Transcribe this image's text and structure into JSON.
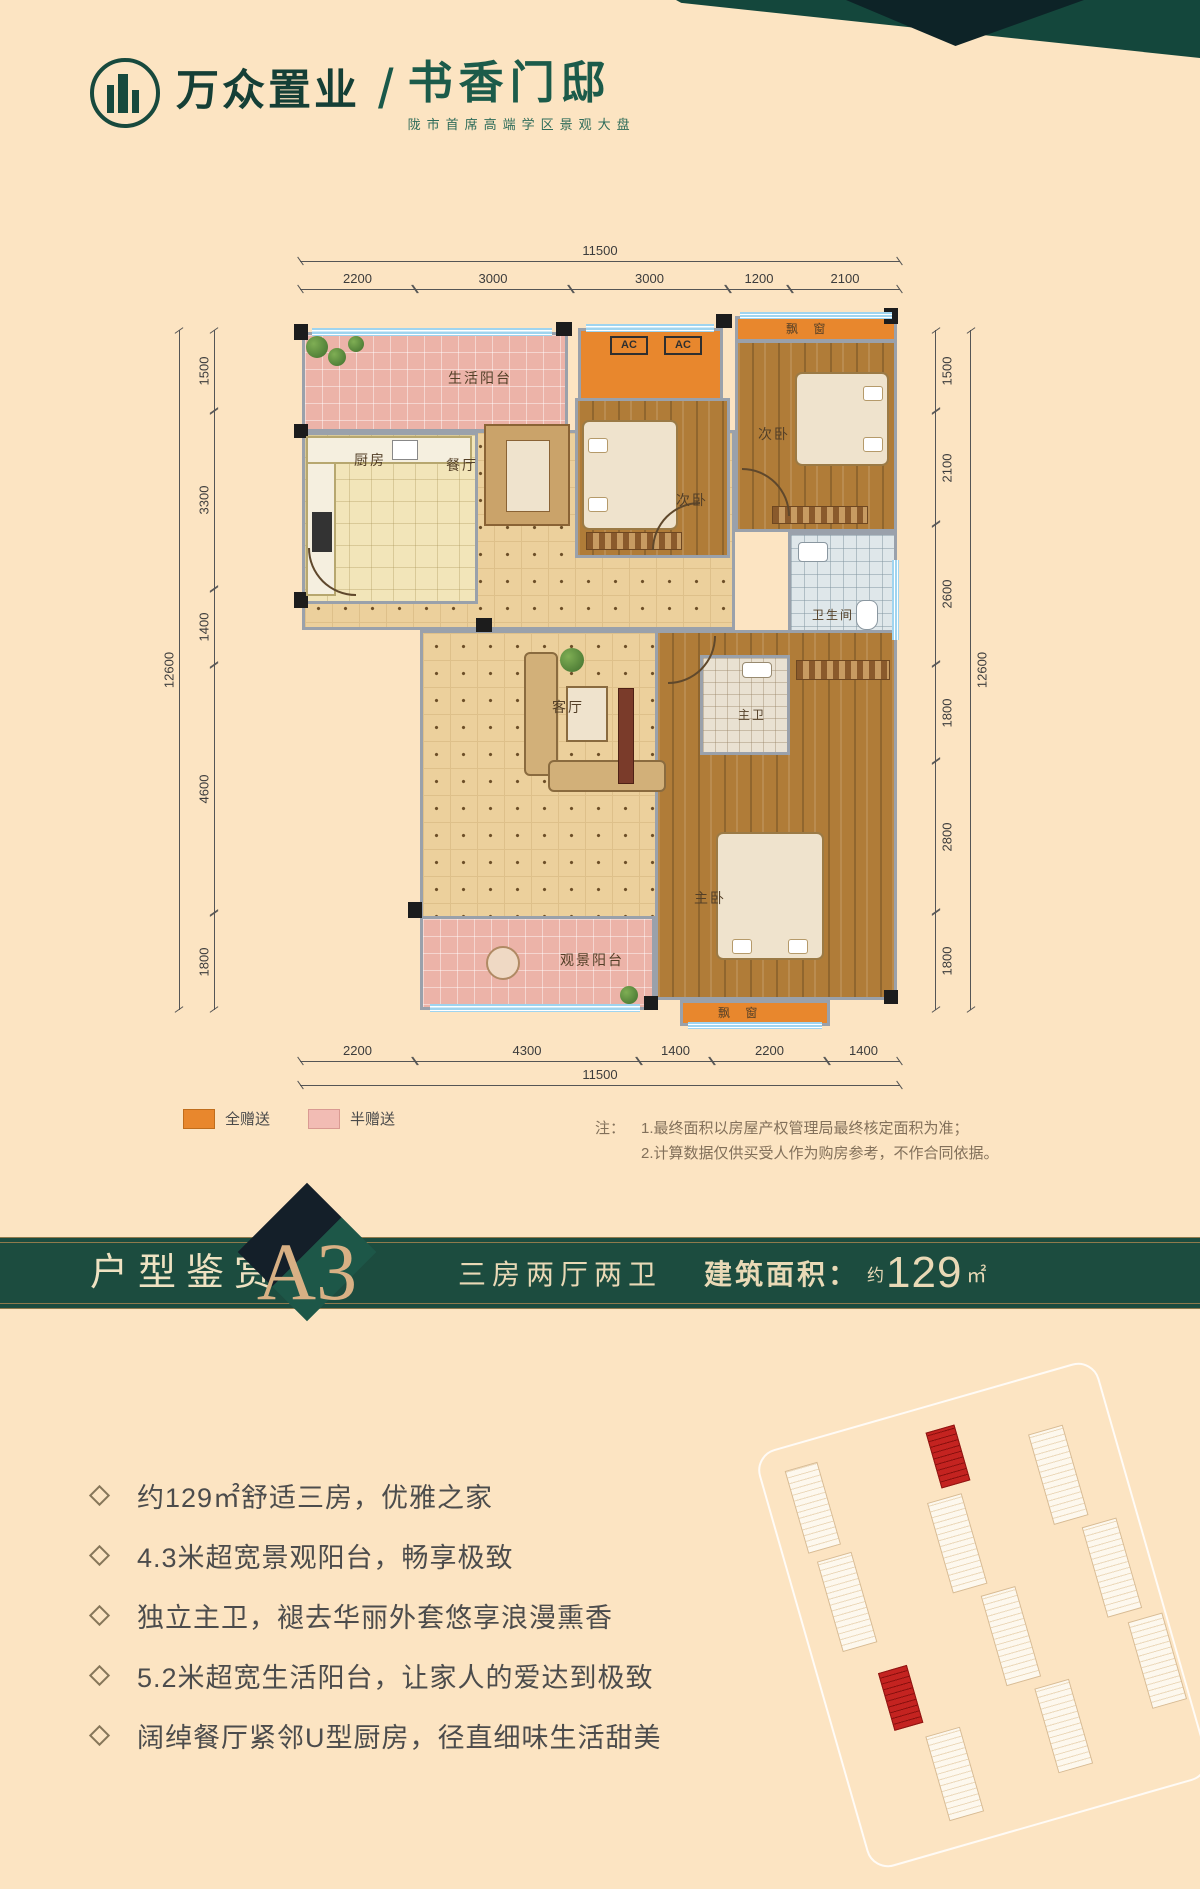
{
  "brand": {
    "company": "万众置业",
    "divider": "/",
    "project": "书香门邸",
    "tagline": "陇市首席高端学区景观大盘"
  },
  "plan": {
    "rooms": {
      "living_balcony": "生活阳台",
      "kitchen": "厨房",
      "dining": "餐厅",
      "secondary_bedroom": "次卧",
      "living_room": "客厅",
      "bathroom": "卫生间",
      "master_bathroom": "主卫",
      "master_bedroom": "主卧",
      "view_balcony": "观景阳台",
      "bay_window": "飘 窗",
      "ac": "AC"
    },
    "dims": {
      "top_total": "11500",
      "top_segments": [
        "2200",
        "3000",
        "3000",
        "1200",
        "2100"
      ],
      "bottom_segments": [
        "2200",
        "4300",
        "1400",
        "2200",
        "1400"
      ],
      "bottom_total": "11500",
      "left_segments": [
        "1500",
        "3300",
        "1400",
        "4600",
        "1800"
      ],
      "left_total": "12600",
      "right_segments": [
        "1500",
        "2100",
        "2600",
        "1800",
        "2800",
        "1800"
      ],
      "right_total": "12600"
    }
  },
  "legend": {
    "full_gift": "全赠送",
    "half_gift": "半赠送"
  },
  "notes": {
    "prefix": "注：",
    "line1": "1.最终面积以房屋产权管理局最终核定面积为准；",
    "line2": "2.计算数据仅供买受人作为购房参考，不作合同依据。"
  },
  "banner": {
    "section_title": "户型鉴赏",
    "unit_code": "A3",
    "layout": "三房两厅两卫",
    "area_label": "建筑面积：",
    "area_prefix": "约",
    "area_value": "129",
    "area_unit": "㎡"
  },
  "features": [
    "约129㎡舒适三房，优雅之家",
    "4.3米超宽景观阳台，畅享极致",
    "独立主卫，褪去华丽外套悠享浪漫熏香",
    "5.2米超宽生活阳台，让家人的爱达到极致",
    "阔绰餐厅紧邻U型厨房，径直细味生活甜美"
  ],
  "colors": {
    "brand_green": "#1c4c3f",
    "gold": "#8f7a4d",
    "full_gift_orange": "#e8872d",
    "half_gift_pink": "#ecb3a8",
    "highlight_red": "#c42320",
    "background_cream": "#fce4c2"
  }
}
